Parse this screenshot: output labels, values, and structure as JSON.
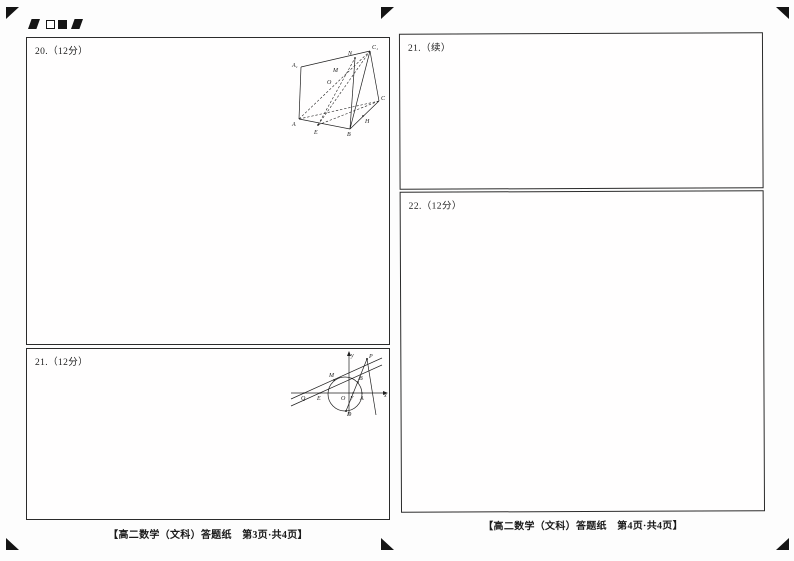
{
  "sheet": {
    "left": {
      "box20_label": "20.（12分）",
      "box21_label": "21.（12分）",
      "footer": "【高二数学（文科）答题纸　第3页·共4页】"
    },
    "right": {
      "box21cont_label": "21.（续）",
      "box22_label": "22.（12分）",
      "footer": "【高二数学（文科）答题纸　第4页·共4页】"
    }
  },
  "figures": {
    "prism": {
      "labels": {
        "A1": "A₁",
        "C1": "C₁",
        "N": "N",
        "M": "M",
        "O": "O",
        "A": "A",
        "E": "E",
        "B": "B",
        "H": "H",
        "C": "C"
      }
    },
    "conic": {
      "labels": {
        "y": "y",
        "x": "x",
        "P": "P",
        "M": "M",
        "B": "B",
        "Q": "Q",
        "E": "E",
        "O": "O",
        "F": "F",
        "A": "A",
        "D": "D"
      }
    }
  },
  "colors": {
    "ink": "#1a1a1a",
    "paper": "#fdfdfd"
  }
}
